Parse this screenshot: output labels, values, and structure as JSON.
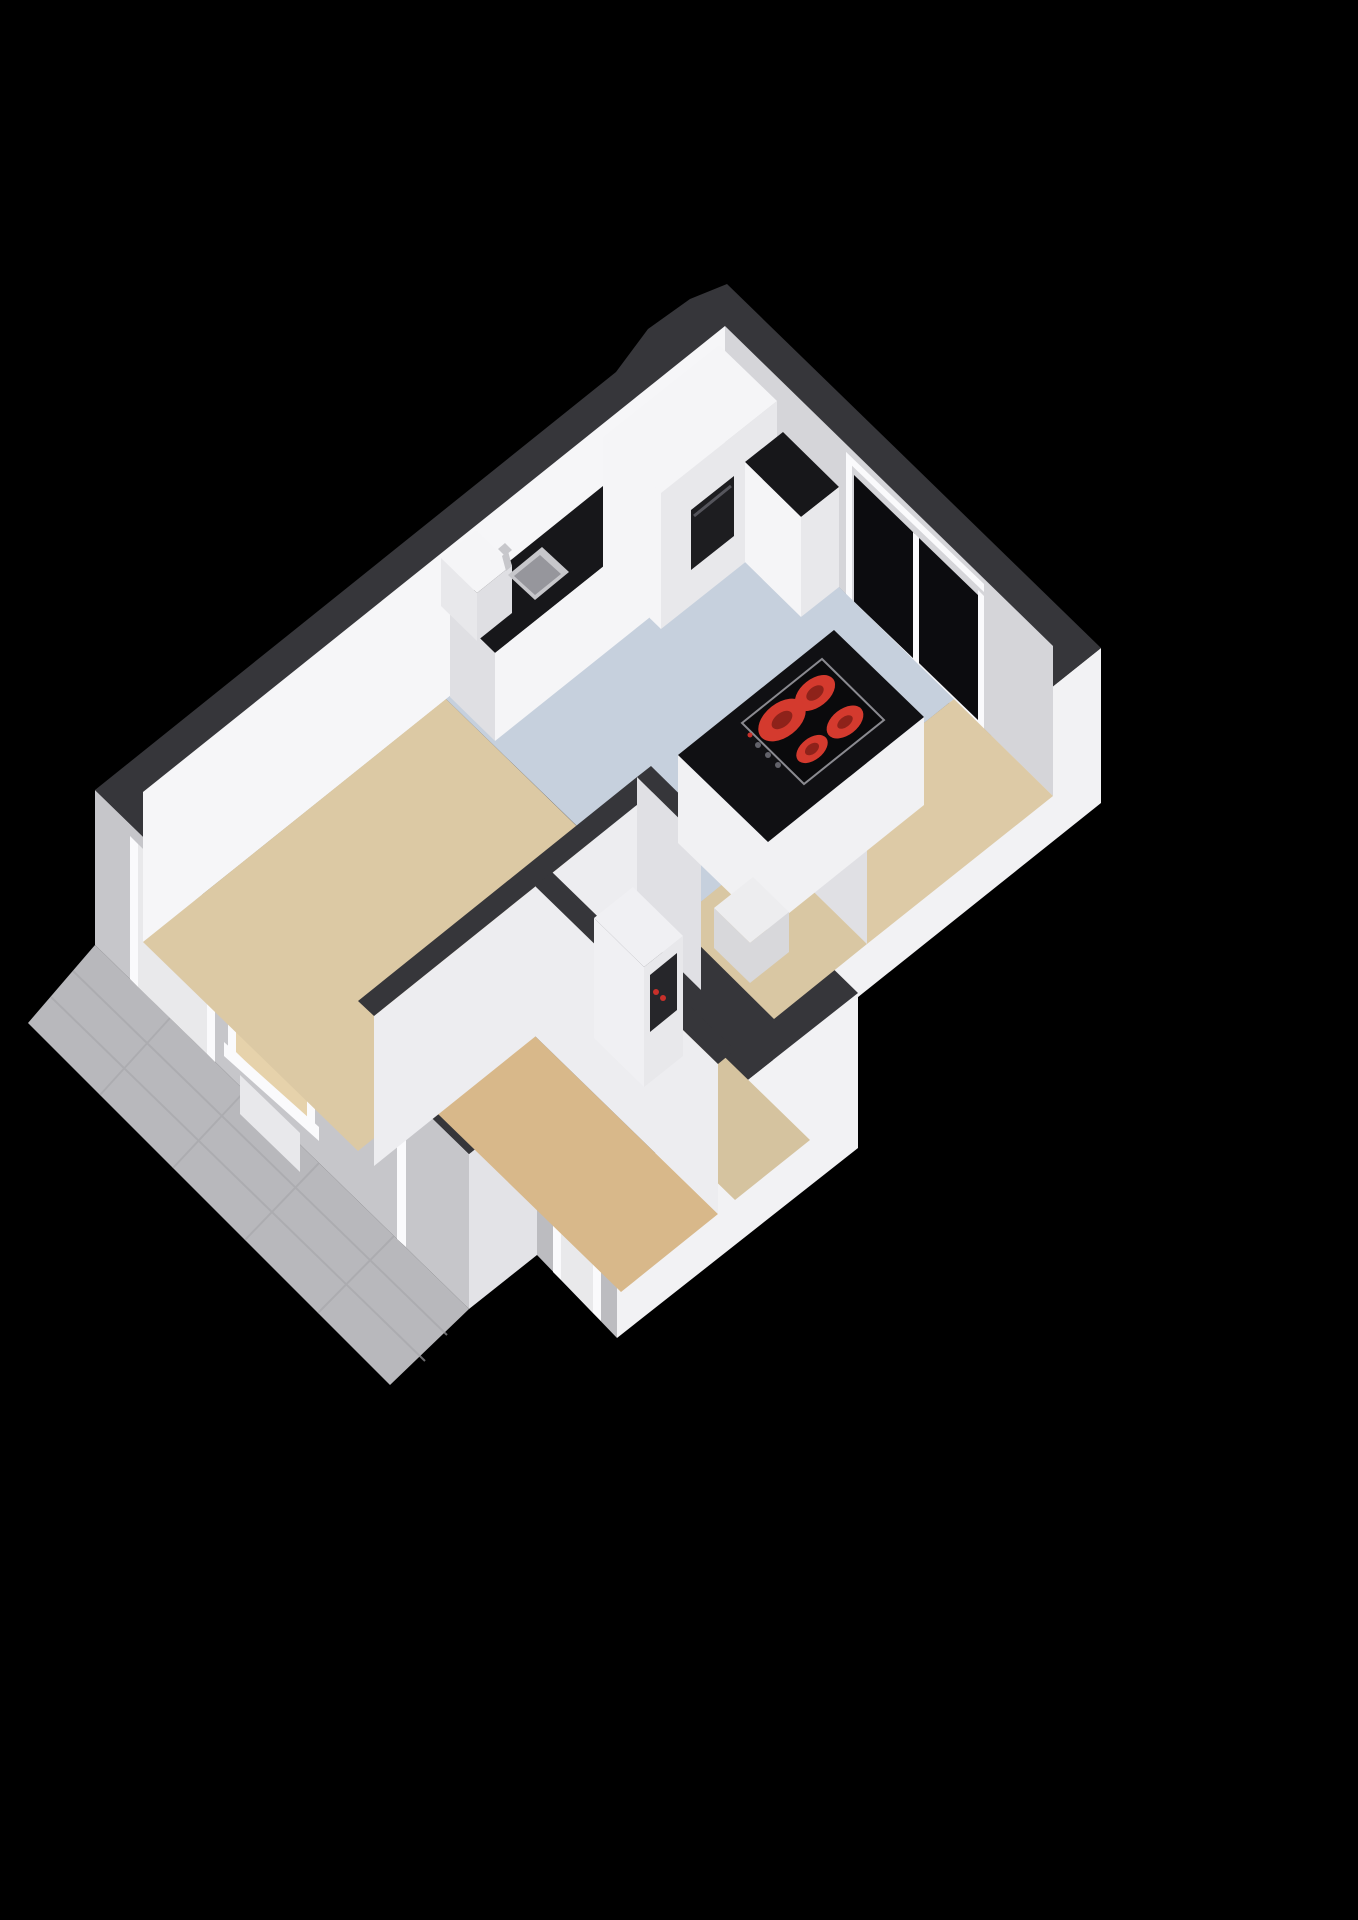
{
  "scene": {
    "type": "3d-floorplan-render",
    "view": "axonometric",
    "background": "#000000"
  },
  "colors": {
    "background": "#000000",
    "wall_top": "#36363a",
    "ext_sw": "#c6c6ca",
    "ext_sw_wing": "#bcbcc0",
    "ext_se": "#f2f2f4",
    "ext_se_step": "#e3e3e7",
    "inner_nw": "#f6f6f8",
    "inner_ne": "#d5d5d9",
    "partition_face": "#ededf0",
    "partition_face_alt": "#e0e0e4",
    "floor_living": "#dcc9a4",
    "floor_kitchen": "#c6d0dd",
    "floor_hall": "#d9c7a3",
    "floor_bedroom": "#ddcaa6",
    "floor_bath": "#d8b88a",
    "floor_entry": "#d5c39f",
    "counter_top": "#17171a",
    "cabinet_white": "#f5f5f7",
    "cabinet_side": "#e8e8eb",
    "cabinet_end": "#dfdfe3",
    "oven": "#1d1d20",
    "island_top": "#101013",
    "island_body": "#f1f1f3",
    "cooktop": "#0a0a0c",
    "cooktop_rim": "#8a8a90",
    "burner": "#d43a2e",
    "burner_dark": "#8e221a",
    "glass": "#0c0c0f",
    "frame_white": "#fafafc",
    "door_panel": "#e9e9eb",
    "terrace": "#b8b8bc",
    "tile_line": "#a7a7ab",
    "sink_steel": "#c7c7cb",
    "sink_basin": "#96969c",
    "handle": "#8a8a90",
    "device_white": "#f0f0f3",
    "device_slot": "#26262a",
    "device_red": "#c8302a",
    "step_white": "#ededef",
    "step_side": "#d8d8db",
    "window_glow": "#e6d2ab"
  },
  "rooms": [
    {
      "id": "living-room",
      "floor": "floor_living"
    },
    {
      "id": "kitchen",
      "floor": "floor_kitchen"
    },
    {
      "id": "hall",
      "floor": "floor_hall"
    },
    {
      "id": "bedroom",
      "floor": "floor_bedroom"
    },
    {
      "id": "bathroom",
      "floor": "floor_bath"
    },
    {
      "id": "entry",
      "floor": "floor_entry"
    }
  ],
  "fixtures": [
    "terrace",
    "front-door",
    "front-window",
    "side-door",
    "sliding-window",
    "kitchen-counter",
    "sink",
    "tall-cabinet",
    "oven",
    "corner-cabinet",
    "kitchen-island",
    "cooktop",
    "burners",
    "meter-cabinet",
    "entry-step"
  ]
}
